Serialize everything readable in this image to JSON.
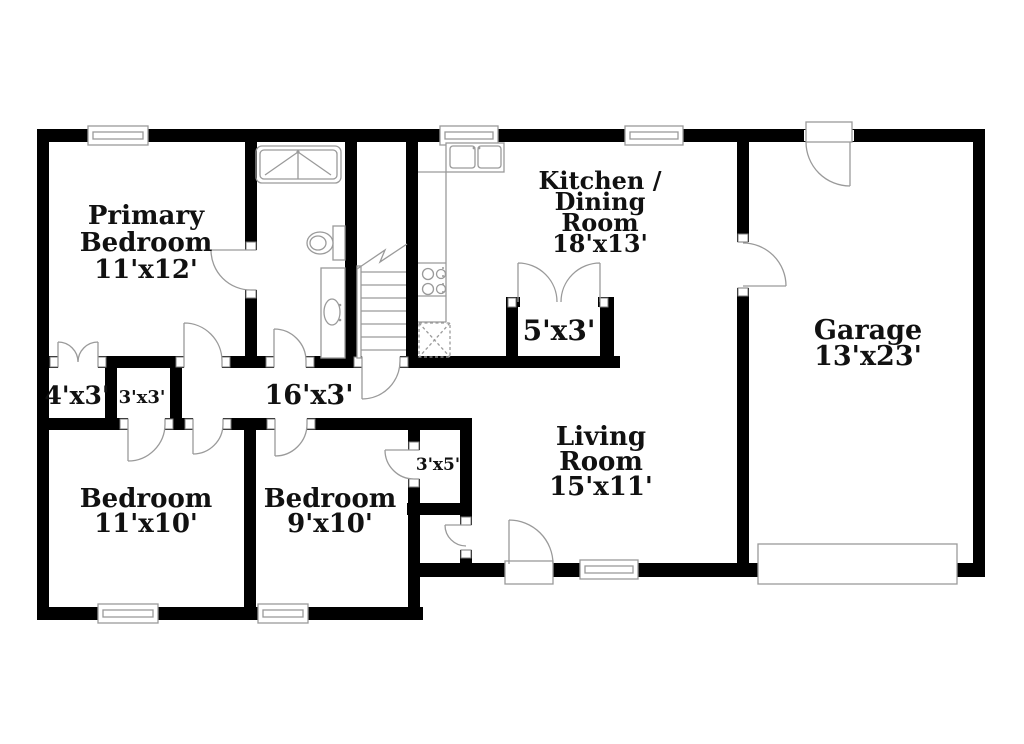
{
  "floor_plan": {
    "title": "Single-story house floor plan",
    "rooms": [
      {
        "id": "primary-bedroom",
        "lines": [
          "Primary",
          "Bedroom"
        ],
        "dims": "11'x12'"
      },
      {
        "id": "kitchen-dining-room",
        "lines": [
          "Kitchen /",
          "Dining",
          "Room"
        ],
        "dims": "18'x13'"
      },
      {
        "id": "garage",
        "lines": [
          "Garage"
        ],
        "dims": "13'x23'"
      },
      {
        "id": "living-room",
        "lines": [
          "Living",
          "Room"
        ],
        "dims": "15'x11'"
      },
      {
        "id": "bedroom-2",
        "lines": [
          "Bedroom"
        ],
        "dims": "11'x10'"
      },
      {
        "id": "bedroom-3",
        "lines": [
          "Bedroom"
        ],
        "dims": "9'x10'"
      }
    ],
    "small_areas": [
      {
        "id": "primary-closet",
        "dims": "4'x3'"
      },
      {
        "id": "hall-closet",
        "dims": "3'x3'"
      },
      {
        "id": "hallway",
        "dims": "16'x3'"
      },
      {
        "id": "dining-closet",
        "dims": "5'x3'"
      },
      {
        "id": "bedroom-3-closet",
        "dims": "3'x5'"
      }
    ],
    "fixtures": [
      "bathtub-shower",
      "toilet",
      "vanity-sink",
      "stairs",
      "kitchen-double-sink",
      "range-burners",
      "appliance-box",
      "garage-overhead-door",
      "front-door",
      "windows"
    ],
    "colors": {
      "wall": "#000000",
      "fixture_line": "#9a9a9a",
      "background": "#ffffff",
      "text": "#111111"
    }
  }
}
